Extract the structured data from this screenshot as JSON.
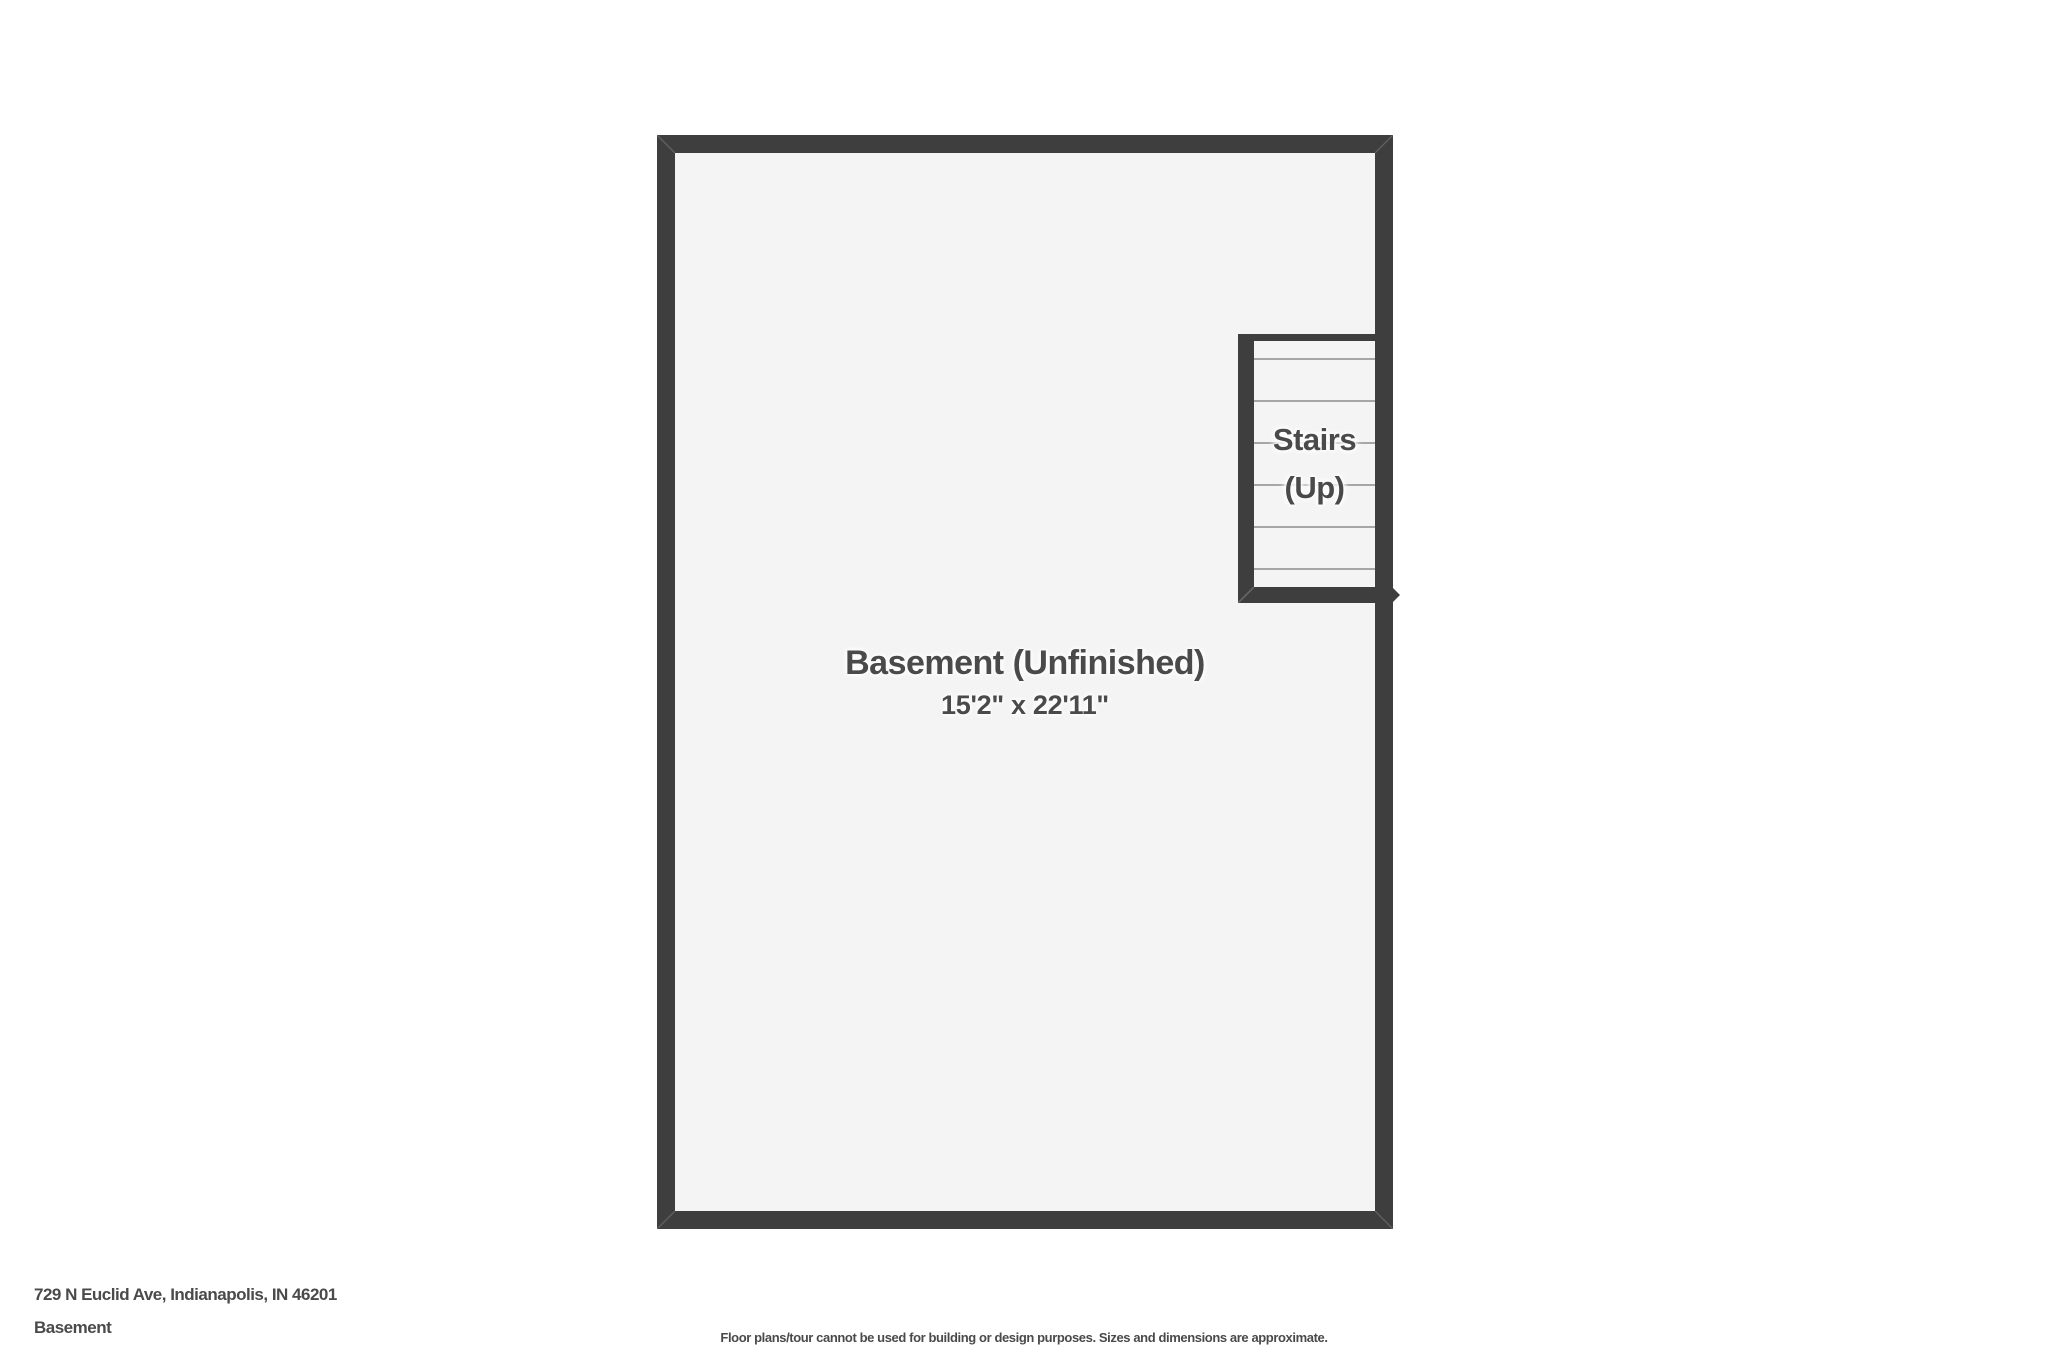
{
  "floorplan": {
    "room": {
      "name": "Basement (Unfinished)",
      "dimensions": "15'2\" x 22'11\""
    },
    "stairs": {
      "label_line1": "Stairs",
      "label_line2": "(Up)",
      "tread_line_count": 6
    },
    "colors": {
      "wall": "#3e3e3e",
      "floor": "#f4f4f5",
      "tread_line": "#a6a6a6",
      "text": "#4a4a4a",
      "page_background": "#ffffff"
    }
  },
  "footer": {
    "address": "729 N Euclid Ave, Indianapolis, IN 46201",
    "floor_label": "Basement",
    "disclaimer": "Floor plans/tour cannot be used for building or design purposes. Sizes and dimensions are approximate."
  }
}
